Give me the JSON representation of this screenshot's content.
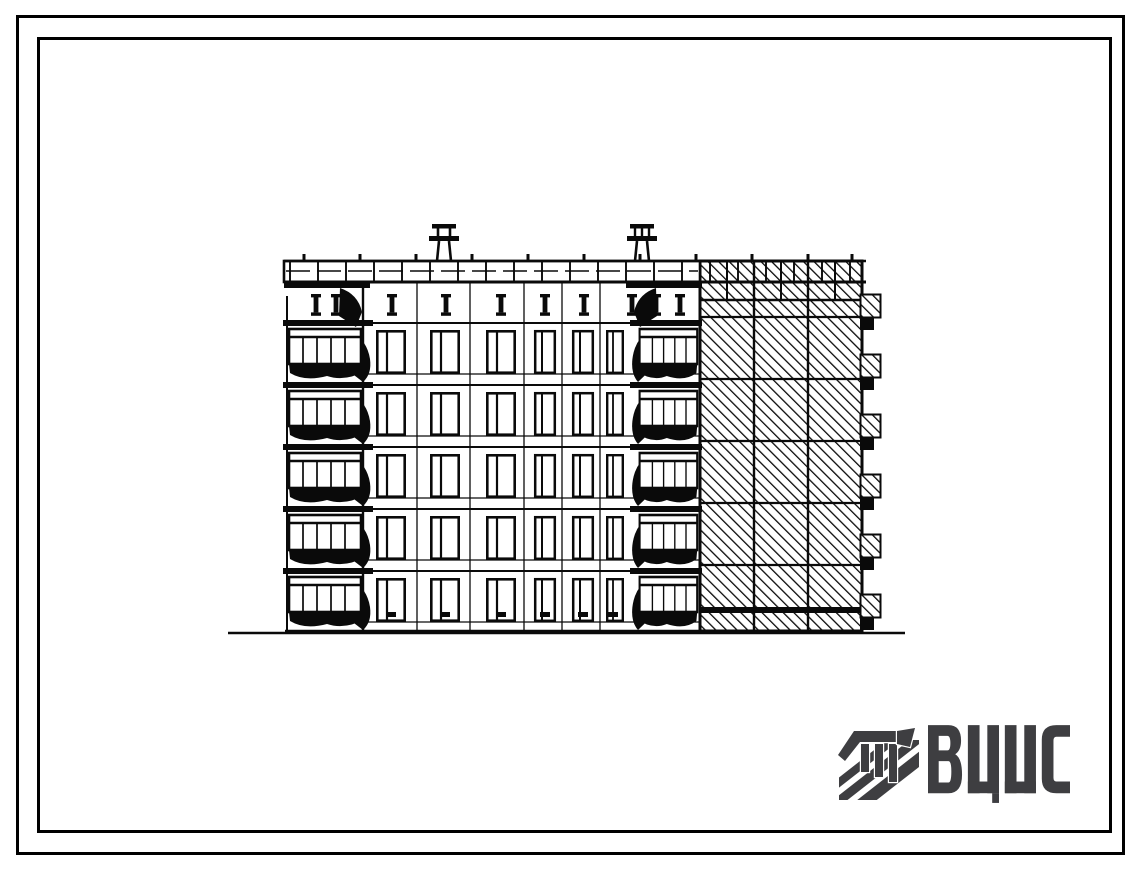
{
  "page": {
    "kind": "scanned architectural drawing sheet",
    "background_color": "#ffffff",
    "frame_color": "#000000",
    "ink_color": "#0a0a0a"
  },
  "drawing": {
    "subject": "End elevation of a 5-storey large-panel apartment block",
    "floors_visible": 5,
    "features": [
      "left balcony stack",
      "window grid facade",
      "second balcony stack",
      "diagonally hatched end wall",
      "roof vent stacks",
      "ground line"
    ]
  },
  "logo": {
    "text": "ВЦИС",
    "color": "#3e3e41",
    "emblem": "striped-flag-monogram"
  }
}
